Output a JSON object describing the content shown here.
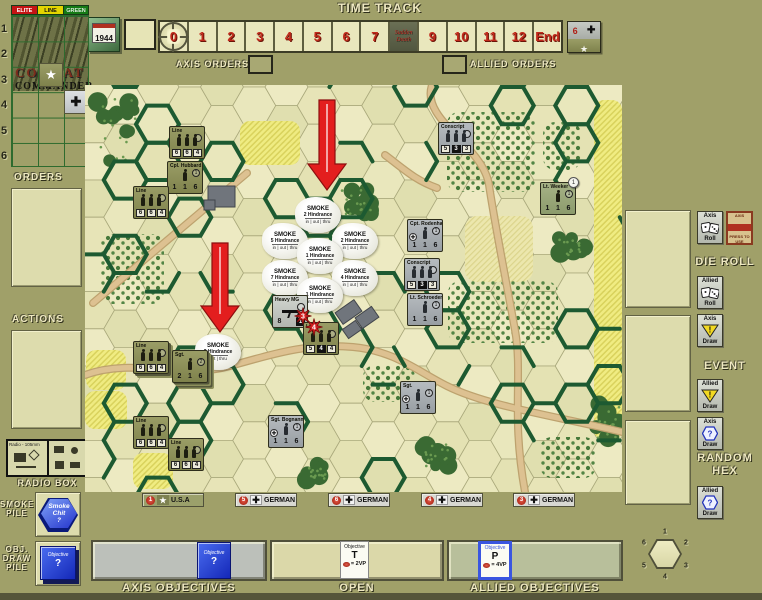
{
  "header": {
    "time_track_title": "TIME TRACK",
    "axis_orders_label": "AXIS ORDERS",
    "allied_orders_label": "ALLIED ORDERS"
  },
  "time_track": {
    "year": "1944",
    "cells": [
      "0",
      "1",
      "2",
      "3",
      "4",
      "5",
      "6",
      "7",
      "8",
      "9",
      "10",
      "11",
      "12",
      "End"
    ],
    "current_index": 0,
    "sudden_death_index": 8,
    "sudden_death_line_1": "Sudden",
    "sudden_death_line_2": "Death",
    "turn_counter": {
      "value": "6",
      "axis_icon": "✚",
      "allied_icon": "★"
    }
  },
  "roster": {
    "columns": [
      "ELITE",
      "LINE",
      "GREEN"
    ],
    "rows": [
      "1",
      "2",
      "3",
      "4",
      "5",
      "6"
    ],
    "logo_line_1": "COMBAT",
    "logo_line_2": "COMMANDER",
    "us_chit_icon": "★",
    "german_chit_icon": "✚"
  },
  "left_panel": {
    "orders_label": "ORDERS",
    "actions_label": "ACTIONS",
    "radio_box_label": "RADIO BOX",
    "radio_text": "Radio - 105mm",
    "smoke_pile_label": "SMOKE\nPILE",
    "smoke_chit_text": "Smoke\nChit\n?",
    "obj_pile_label": "OBJ.\nDRAW\nPILE",
    "obj_chit_title": "Objective",
    "obj_chit_value": "?"
  },
  "right_panel": {
    "die_roll_label": "DIE ROLL",
    "event_label": "EVENT",
    "random_hex_label": "RANDOM HEX",
    "axis_roll": {
      "top": "Axis",
      "bottom": "Roll"
    },
    "allied_roll": {
      "top": "Allied",
      "bottom": "Roll"
    },
    "axis_event": {
      "top": "Axis",
      "bottom": "Draw"
    },
    "allied_event": {
      "top": "Allied",
      "bottom": "Draw"
    },
    "axis_hex": {
      "top": "Axis",
      "bottom": "Draw"
    },
    "allied_hex": {
      "top": "Allied",
      "bottom": "Draw"
    },
    "axis_card_top": "AXIS",
    "axis_card_bottom": "PRESS TO USE"
  },
  "plaques": [
    {
      "num": "1",
      "flag": "usa",
      "label": "U.S.A",
      "x": 142,
      "w": 62
    },
    {
      "num": "5",
      "flag": "german",
      "label": "GERMAN",
      "x": 235,
      "w": 62
    },
    {
      "num": "6",
      "flag": "german",
      "label": "GERMAN",
      "x": 328,
      "w": 62
    },
    {
      "num": "4",
      "flag": "german",
      "label": "GERMAN",
      "x": 421,
      "w": 62
    },
    {
      "num": "3",
      "flag": "german",
      "label": "GERMAN",
      "x": 513,
      "w": 62
    }
  ],
  "bottom": {
    "axis_objectives_label": "AXIS OBJECTIVES",
    "open_label": "OPEN",
    "allied_objectives_label": "ALLIED OBJECTIVES",
    "axis_chit": {
      "title": "Objective",
      "value": "?"
    },
    "open_chit": {
      "title": "Objective",
      "letter": "T",
      "vp": "= 2VP"
    },
    "allied_chit": {
      "title": "Objective",
      "letter": "P",
      "vp": "= 4VP"
    },
    "compass_numbers": [
      "1",
      "2",
      "3",
      "4",
      "5",
      "6"
    ]
  },
  "map": {
    "smoke_word": "SMOKE",
    "hindrance_word": "Hindrance",
    "units": [
      {
        "side": "us",
        "name": "Line",
        "type": "squad",
        "stats": [
          "6",
          "6",
          "4"
        ],
        "x": 169,
        "y": 126
      },
      {
        "side": "us",
        "name": "Cpl. Hubbard",
        "type": "leader",
        "stats": [
          "1",
          "1",
          "6"
        ],
        "cmd": "1",
        "x": 167,
        "y": 161
      },
      {
        "side": "us",
        "name": "Line",
        "type": "squad",
        "stats": [
          "6",
          "6",
          "4"
        ],
        "x": 133,
        "y": 186
      },
      {
        "side": "german",
        "name": "Conscript",
        "type": "squad",
        "stats": [
          "5",
          "3",
          "3"
        ],
        "boxed": 1,
        "x": 438,
        "y": 122
      },
      {
        "side": "elite",
        "name": "Lt. Weeker",
        "type": "leader",
        "stats": [
          "1",
          "1",
          "6"
        ],
        "cmd": "1",
        "disc": "1",
        "x": 540,
        "y": 182
      },
      {
        "side": "german",
        "name": "Cpt. Rodenhaus",
        "type": "leader",
        "stats": [
          "1",
          "1",
          "6"
        ],
        "cmd": "1",
        "medal": true,
        "x": 407,
        "y": 219
      },
      {
        "side": "german",
        "name": "Conscript",
        "type": "squad",
        "stats": [
          "5",
          "3",
          "3"
        ],
        "boxed": 1,
        "x": 404,
        "y": 258
      },
      {
        "side": "german",
        "name": "Lt. Schroeder",
        "type": "leader",
        "stats": [
          "1",
          "1",
          "6"
        ],
        "cmd": "1",
        "x": 407,
        "y": 293
      },
      {
        "side": "weapon",
        "name": "Heavy MG",
        "type": "weapon",
        "stats": [
          "8",
          "1"
        ],
        "x": 272,
        "y": 295
      },
      {
        "side": "us",
        "name": "Line",
        "type": "squad",
        "stats": [
          "5",
          "4",
          "4"
        ],
        "boxed": 1,
        "x": 303,
        "y": 322
      },
      {
        "side": "us",
        "name": "Line",
        "type": "squad",
        "stats": [
          "6",
          "6",
          "4"
        ],
        "stack": 2,
        "x": 133,
        "y": 341
      },
      {
        "side": "us",
        "name": "Sgt.",
        "type": "leader",
        "stats": [
          "2",
          "1",
          "6"
        ],
        "cmd": "2",
        "stack": 4,
        "x": 172,
        "y": 350
      },
      {
        "side": "german",
        "name": "Sgt. Bognanno",
        "type": "leader",
        "stats": [
          "1",
          "1",
          "6"
        ],
        "cmd": "1",
        "medal": true,
        "x": 268,
        "y": 415
      },
      {
        "side": "german",
        "name": "Sgt.",
        "type": "leader",
        "stats": [
          "1",
          "1",
          "6"
        ],
        "cmd": "1",
        "medal": true,
        "x": 400,
        "y": 381
      },
      {
        "side": "us",
        "name": "Line",
        "type": "squad",
        "stats": [
          "6",
          "6",
          "4"
        ],
        "x": 133,
        "y": 416
      },
      {
        "side": "us",
        "name": "Line",
        "type": "squad",
        "stats": [
          "6",
          "6",
          "4"
        ],
        "x": 168,
        "y": 438
      }
    ],
    "smoke": [
      {
        "x": 318,
        "y": 215,
        "value": "2",
        "modes": "in | out | thru"
      },
      {
        "x": 285,
        "y": 241,
        "value": "5",
        "modes": "in | out | thru"
      },
      {
        "x": 355,
        "y": 241,
        "value": "2",
        "modes": "in | out | thru"
      },
      {
        "x": 320,
        "y": 256,
        "value": "1",
        "modes": "in | out | thru"
      },
      {
        "x": 285,
        "y": 278,
        "value": "7",
        "modes": "in | out | thru"
      },
      {
        "x": 355,
        "y": 278,
        "value": "4",
        "modes": "in | out | thru"
      },
      {
        "x": 320,
        "y": 295,
        "value": "1",
        "modes": "in | out | thru"
      },
      {
        "x": 218,
        "y": 352,
        "value": "2",
        "modes": "out | thru"
      }
    ],
    "arrows": [
      {
        "x": 327,
        "top": 100,
        "tip": 190
      },
      {
        "x": 220,
        "top": 243,
        "tip": 332
      }
    ],
    "explosions": [
      {
        "x": 303,
        "y": 316,
        "value": "3"
      },
      {
        "x": 314,
        "y": 327,
        "value": "4"
      }
    ],
    "terrain": {
      "woods": [
        {
          "x": 118,
          "y": 130,
          "rx": 26,
          "ry": 40
        },
        {
          "x": 357,
          "y": 202,
          "rx": 19,
          "ry": 15
        },
        {
          "x": 571,
          "y": 245,
          "rx": 17,
          "ry": 13
        },
        {
          "x": 606,
          "y": 420,
          "rx": 18,
          "ry": 23
        },
        {
          "x": 437,
          "y": 455,
          "rx": 17,
          "ry": 14
        },
        {
          "x": 317,
          "y": 472,
          "rx": 14,
          "ry": 11
        }
      ],
      "orchards": [
        {
          "x": 447,
          "y": 112,
          "w": 88,
          "h": 80
        },
        {
          "x": 543,
          "y": 122,
          "w": 38,
          "h": 48
        },
        {
          "x": 100,
          "y": 234,
          "w": 64,
          "h": 70
        },
        {
          "x": 448,
          "y": 281,
          "w": 110,
          "h": 62
        },
        {
          "x": 363,
          "y": 365,
          "w": 52,
          "h": 37
        },
        {
          "x": 540,
          "y": 437,
          "w": 56,
          "h": 41
        }
      ],
      "fields_bright": [
        {
          "x": 240,
          "y": 121,
          "w": 60,
          "h": 44
        },
        {
          "x": 86,
          "y": 350,
          "w": 40,
          "h": 40
        },
        {
          "x": 85,
          "y": 391,
          "w": 42,
          "h": 38
        },
        {
          "x": 133,
          "y": 453,
          "w": 40,
          "h": 36
        },
        {
          "x": 594,
          "y": 100,
          "w": 28,
          "h": 340
        }
      ],
      "fields_pale": [
        {
          "x": 465,
          "y": 216,
          "w": 68,
          "h": 66
        }
      ]
    },
    "roads": [
      "M 8,218 L 162,88",
      "M 0,290 C 50,272 95,295 145,281 C 195,267 225,258 268,262 C 310,266 332,286 362,301 C 402,321 470,331 537,347",
      "M 347,0 C 335,35 398,60 404,100 C 410,140 420,190 430,245 C 438,290 426,330 440,407",
      "M 300,70 C 320,85 330,95 352,103"
    ],
    "buildings": [
      {
        "x": 208,
        "y": 186,
        "w": 27,
        "h": 21,
        "rot": 0
      },
      {
        "x": 204,
        "y": 200,
        "w": 11,
        "h": 10,
        "rot": 0
      },
      {
        "x": 337,
        "y": 305,
        "w": 23,
        "h": 14,
        "rot": -35
      },
      {
        "x": 357,
        "y": 311,
        "w": 20,
        "h": 13,
        "rot": -35
      },
      {
        "x": 344,
        "y": 324,
        "w": 16,
        "h": 11,
        "rot": -35
      }
    ]
  }
}
